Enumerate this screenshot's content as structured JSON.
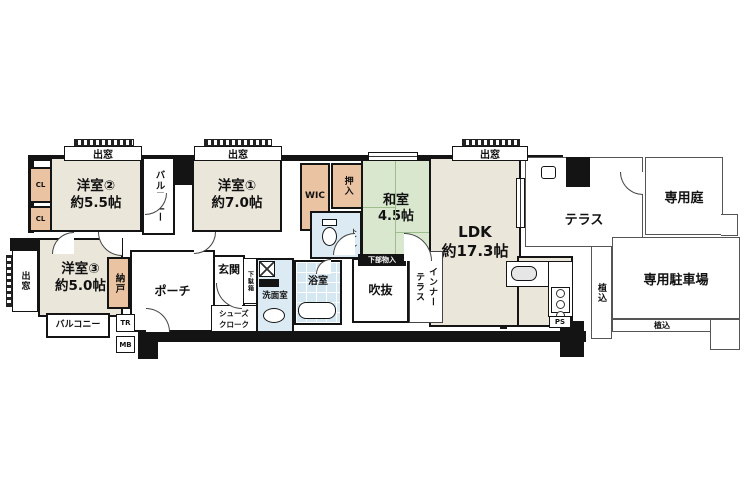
{
  "colors": {
    "wall": "#141414",
    "room_beige": "#eae6da",
    "tatami_green": "#d9e7cf",
    "closet_salmon": "#eac3a2",
    "wet_blue": "#dcebf3",
    "bath_blue": "#d5e7f0"
  },
  "rooms": {
    "yoshitsu2": {
      "label": "洋室②\n約5.5帖"
    },
    "yoshitsu1": {
      "label": "洋室①\n約7.0帖"
    },
    "yoshitsu3": {
      "label": "洋室③\n約5.0帖"
    },
    "washitsu": {
      "label": "和室\n4.5帖"
    },
    "ldk": {
      "label": "LDK\n約17.3帖"
    },
    "balcony_top": {
      "label": "バルコニー"
    },
    "balcony_bottom": {
      "label": "バルコニー"
    },
    "terrace": {
      "label": "テラス"
    },
    "garden": {
      "label": "専用庭"
    },
    "parking": {
      "label": "専用駐車場"
    },
    "inner_terrace": {
      "label": "インナー\nテラス"
    },
    "fukinuke": {
      "label": "吹抜"
    },
    "porch": {
      "label": "ポーチ"
    },
    "genkan": {
      "label": "玄関"
    },
    "nando": {
      "label": "納戸"
    },
    "wic": {
      "label": "WIC"
    },
    "oshiire": {
      "label": "押入"
    },
    "toilet": {
      "label": "トイレ"
    },
    "senmen": {
      "label": "洗面室"
    },
    "bath": {
      "label": "浴室"
    },
    "shoes_cloak": {
      "label": "シューズ\nクローク"
    },
    "getabako": {
      "label": "下駄箱"
    },
    "kabu_monoire": {
      "label": "下部物入"
    },
    "hedge_side": {
      "label": "植込"
    },
    "hedge_bottom": {
      "label": "植込"
    }
  },
  "labels": {
    "demado": "出窓",
    "cl": "CL",
    "tr": "TR",
    "mb": "MB",
    "ps": "PS"
  }
}
